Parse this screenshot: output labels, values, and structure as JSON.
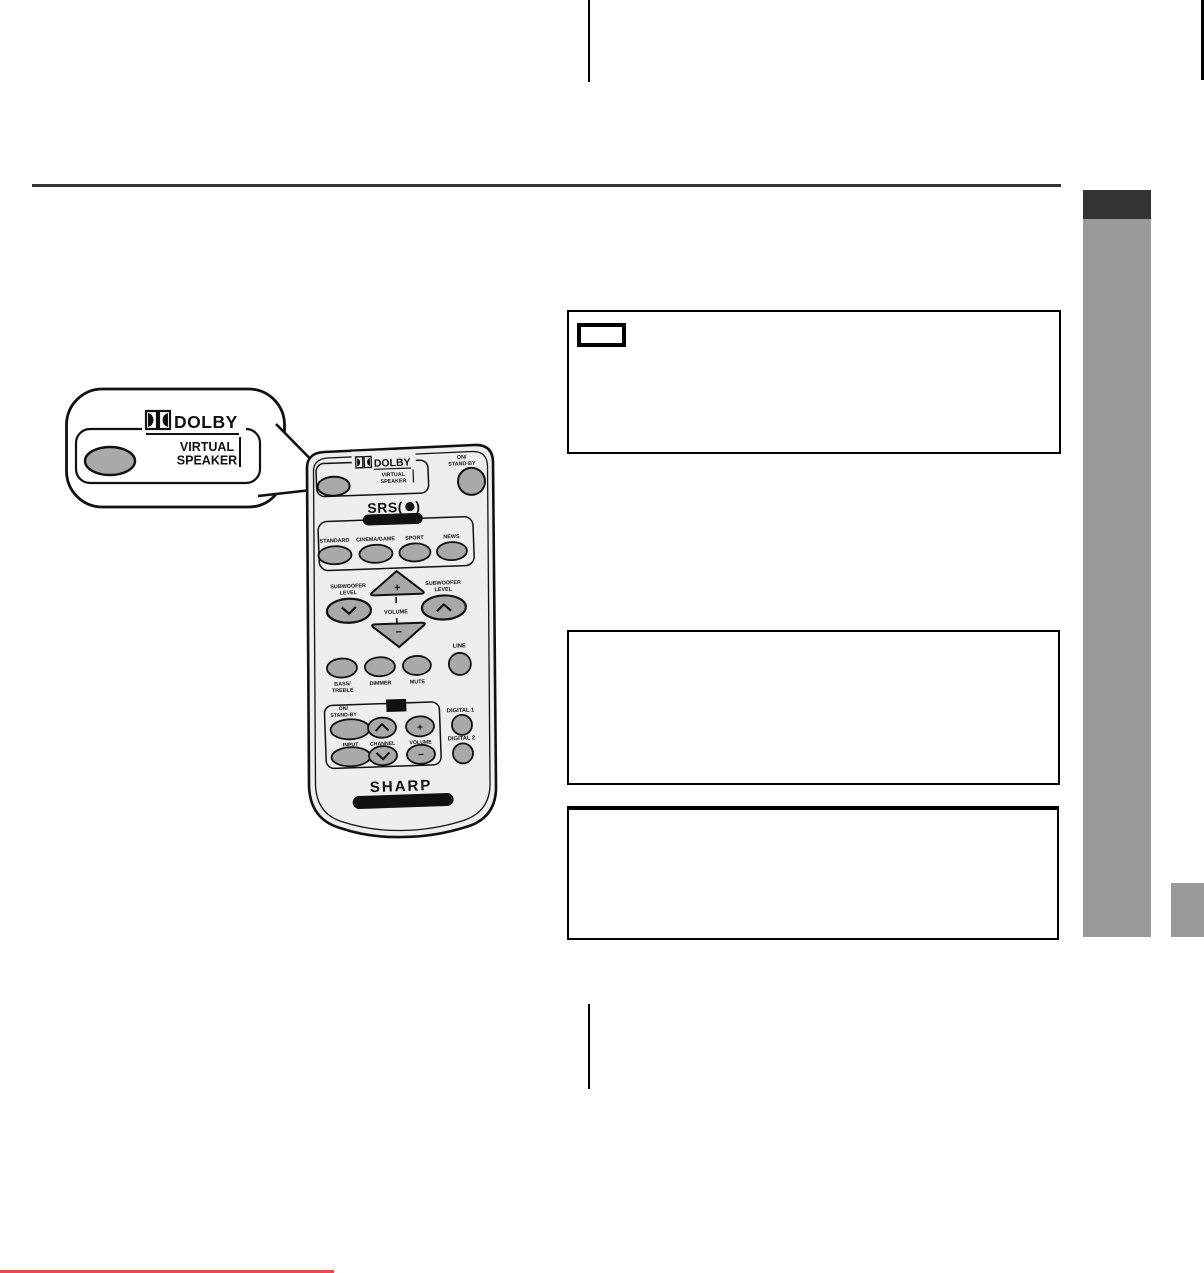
{
  "page": {
    "kind": "sound-bar-system-manual-page"
  },
  "colors": {
    "sidebar_tab": "#333333",
    "sidebar_bar": "#9a9a9a",
    "divider_rule": "#333333",
    "footer_red_line": "#ea4a4e",
    "button_gray": "#a9a9a9",
    "remote_body": "#eeeeee"
  },
  "callout": {
    "brand": "DOLBY",
    "virtual": "VIRTUAL",
    "speaker": "SPEAKER"
  },
  "remote": {
    "dolby_brand": "DOLBY",
    "dolby_virtual": "VIRTUAL",
    "dolby_speaker": "SPEAKER",
    "power1": "ON/",
    "power2": "STAND·BY",
    "srs_prefix": "SRS(",
    "srs_suffix": ")",
    "wow": "WOW HD",
    "modes": [
      "STANDARD",
      "CINEMA/GAME",
      "SPORT",
      "NEWS"
    ],
    "sub1": "SUBWOOFER",
    "sub2": "LEVEL",
    "volume": "VOLUME",
    "plus": "+",
    "minus": "−",
    "bass1": "BASS/",
    "bass2": "TREBLE",
    "dimmer": "DIMMER",
    "mute": "MUTE",
    "line": "LINE",
    "tv": "TV",
    "tv_power1": "ON/",
    "tv_power2": "STAND-BY",
    "input": "INPUT",
    "channel": "CHANNEL",
    "tv_volume": "VOLUME",
    "tv_plus": "+",
    "tv_minus": "−",
    "digital1": "DIGITAL 1",
    "digital2": "DIGITAL 2",
    "brand": "SHARP",
    "product": "SOUND BAR SYSTEM"
  }
}
